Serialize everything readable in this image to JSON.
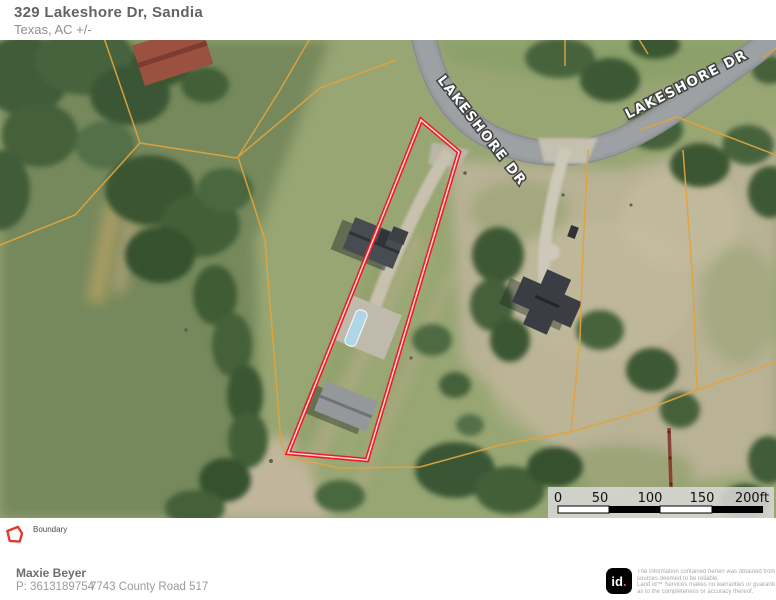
{
  "header": {
    "title": "329 Lakeshore Dr, Sandia",
    "subtitle": "Texas,  AC +/-"
  },
  "map": {
    "road_labels": [
      "LAKESHORE DR",
      "LAKESHORE DR"
    ],
    "scalebar": {
      "labels": [
        "0",
        "50",
        "100",
        "150",
        "200ft"
      ]
    },
    "colors": {
      "boundary": "#ED1B24",
      "parcel_lines": "#E2A33B",
      "road": "#989C9E",
      "pool": "#AED6E6"
    }
  },
  "legend": {
    "items": [
      {
        "label": "Boundary",
        "color": "#E0392E"
      }
    ]
  },
  "footer": {
    "owner_name": "Maxie Beyer",
    "phone": "P: 3613189754",
    "address": "7743 County Road 517",
    "logo": {
      "text": "id",
      "dot": "."
    },
    "disclaimer_lines": [
      "The information contained herein was obtained from",
      "sources deemed to be reliable.",
      "Land id™ Services makes no warranties or guarantees",
      "as to the completeness or accuracy thereof."
    ]
  }
}
